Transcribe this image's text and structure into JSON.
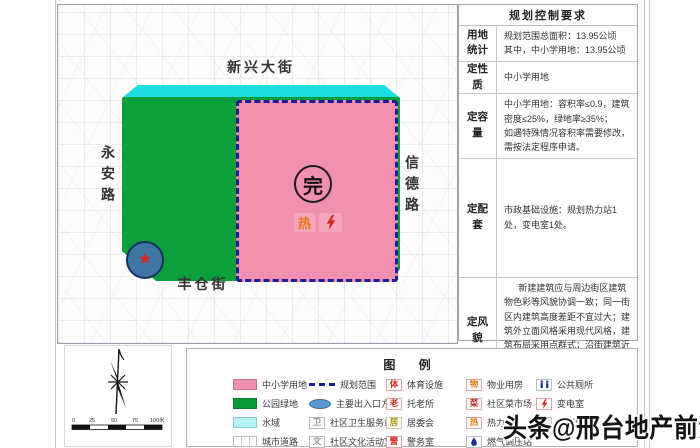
{
  "map": {
    "street_top": "新兴大街",
    "street_left": "永安路",
    "street_right": "信德路",
    "street_bottom": "丰仓街",
    "seal": "完",
    "heat_marker": "热",
    "entrance_marker": "★"
  },
  "table": {
    "title": "规划控制要求",
    "rows": [
      {
        "label": "用地统计",
        "content": "规划范围总面积：13.95公顷\n其中，中小学用地：13.95公顷"
      },
      {
        "label": "定性质",
        "content": "中小学用地"
      },
      {
        "label": "定容量",
        "content": "中小学用地：容积率≤0.9，建筑密度≤25%，绿地率≥35%；\n如遇特殊情况容积率需要修改，需按法定程序申请。"
      },
      {
        "label": "定配套",
        "content": "市政基础设施：规划热力站1处，变电室1处。"
      },
      {
        "label": "定风貌",
        "content": "新建建筑应与周边街区建筑物色彩等风貌协调一致；同一街区内建筑高度差距不宜过大；建筑外立面风格采用现代风格，建筑布局采用点群式；沿街建筑近人尺度应采用石材，其他部位及其他建筑采用真石漆或石材。"
      }
    ]
  },
  "legend": {
    "title": "图 例",
    "columns": [
      {
        "items": [
          {
            "label": "中小学用地"
          },
          {
            "label": "公园绿地"
          },
          {
            "label": "水域"
          },
          {
            "label": "城市道路"
          }
        ]
      },
      {
        "items": [
          {
            "label": "规划范围"
          },
          {
            "label": "主要出入口方向"
          },
          {
            "label": "社区卫生服务站",
            "glyph": "卫"
          },
          {
            "label": "社区文化活动室",
            "glyph": "文"
          }
        ]
      },
      {
        "items": [
          {
            "label": "体育设施",
            "glyph": "体"
          },
          {
            "label": "托老所",
            "glyph": "老"
          },
          {
            "label": "居委会",
            "glyph": "居"
          },
          {
            "label": "警务室",
            "glyph": "警"
          }
        ]
      },
      {
        "items": [
          {
            "label": "物业用房",
            "glyph": "物"
          },
          {
            "label": "社区菜市场",
            "glyph": "菜"
          },
          {
            "label": "热力站",
            "glyph": "热"
          },
          {
            "label": "燃气调压站"
          }
        ]
      },
      {
        "items": [
          {
            "label": "公共厕所"
          },
          {
            "label": "变电室"
          },
          {
            "label": "开闭所",
            "glyph": "开"
          }
        ]
      }
    ]
  },
  "compass": {
    "scale_labels": [
      "0",
      "25",
      "50",
      "75",
      "100米"
    ]
  },
  "watermark": "头条@邢台地产前沿",
  "colors": {
    "school_pink": "#f18fae",
    "park_green": "#0ba03c",
    "water_cyan": "#1fdce0",
    "boundary_navy": "#1c1c96",
    "heat_orange": "#e87a10",
    "electric_red": "#d8281e",
    "utility_blue": "#16318c"
  }
}
